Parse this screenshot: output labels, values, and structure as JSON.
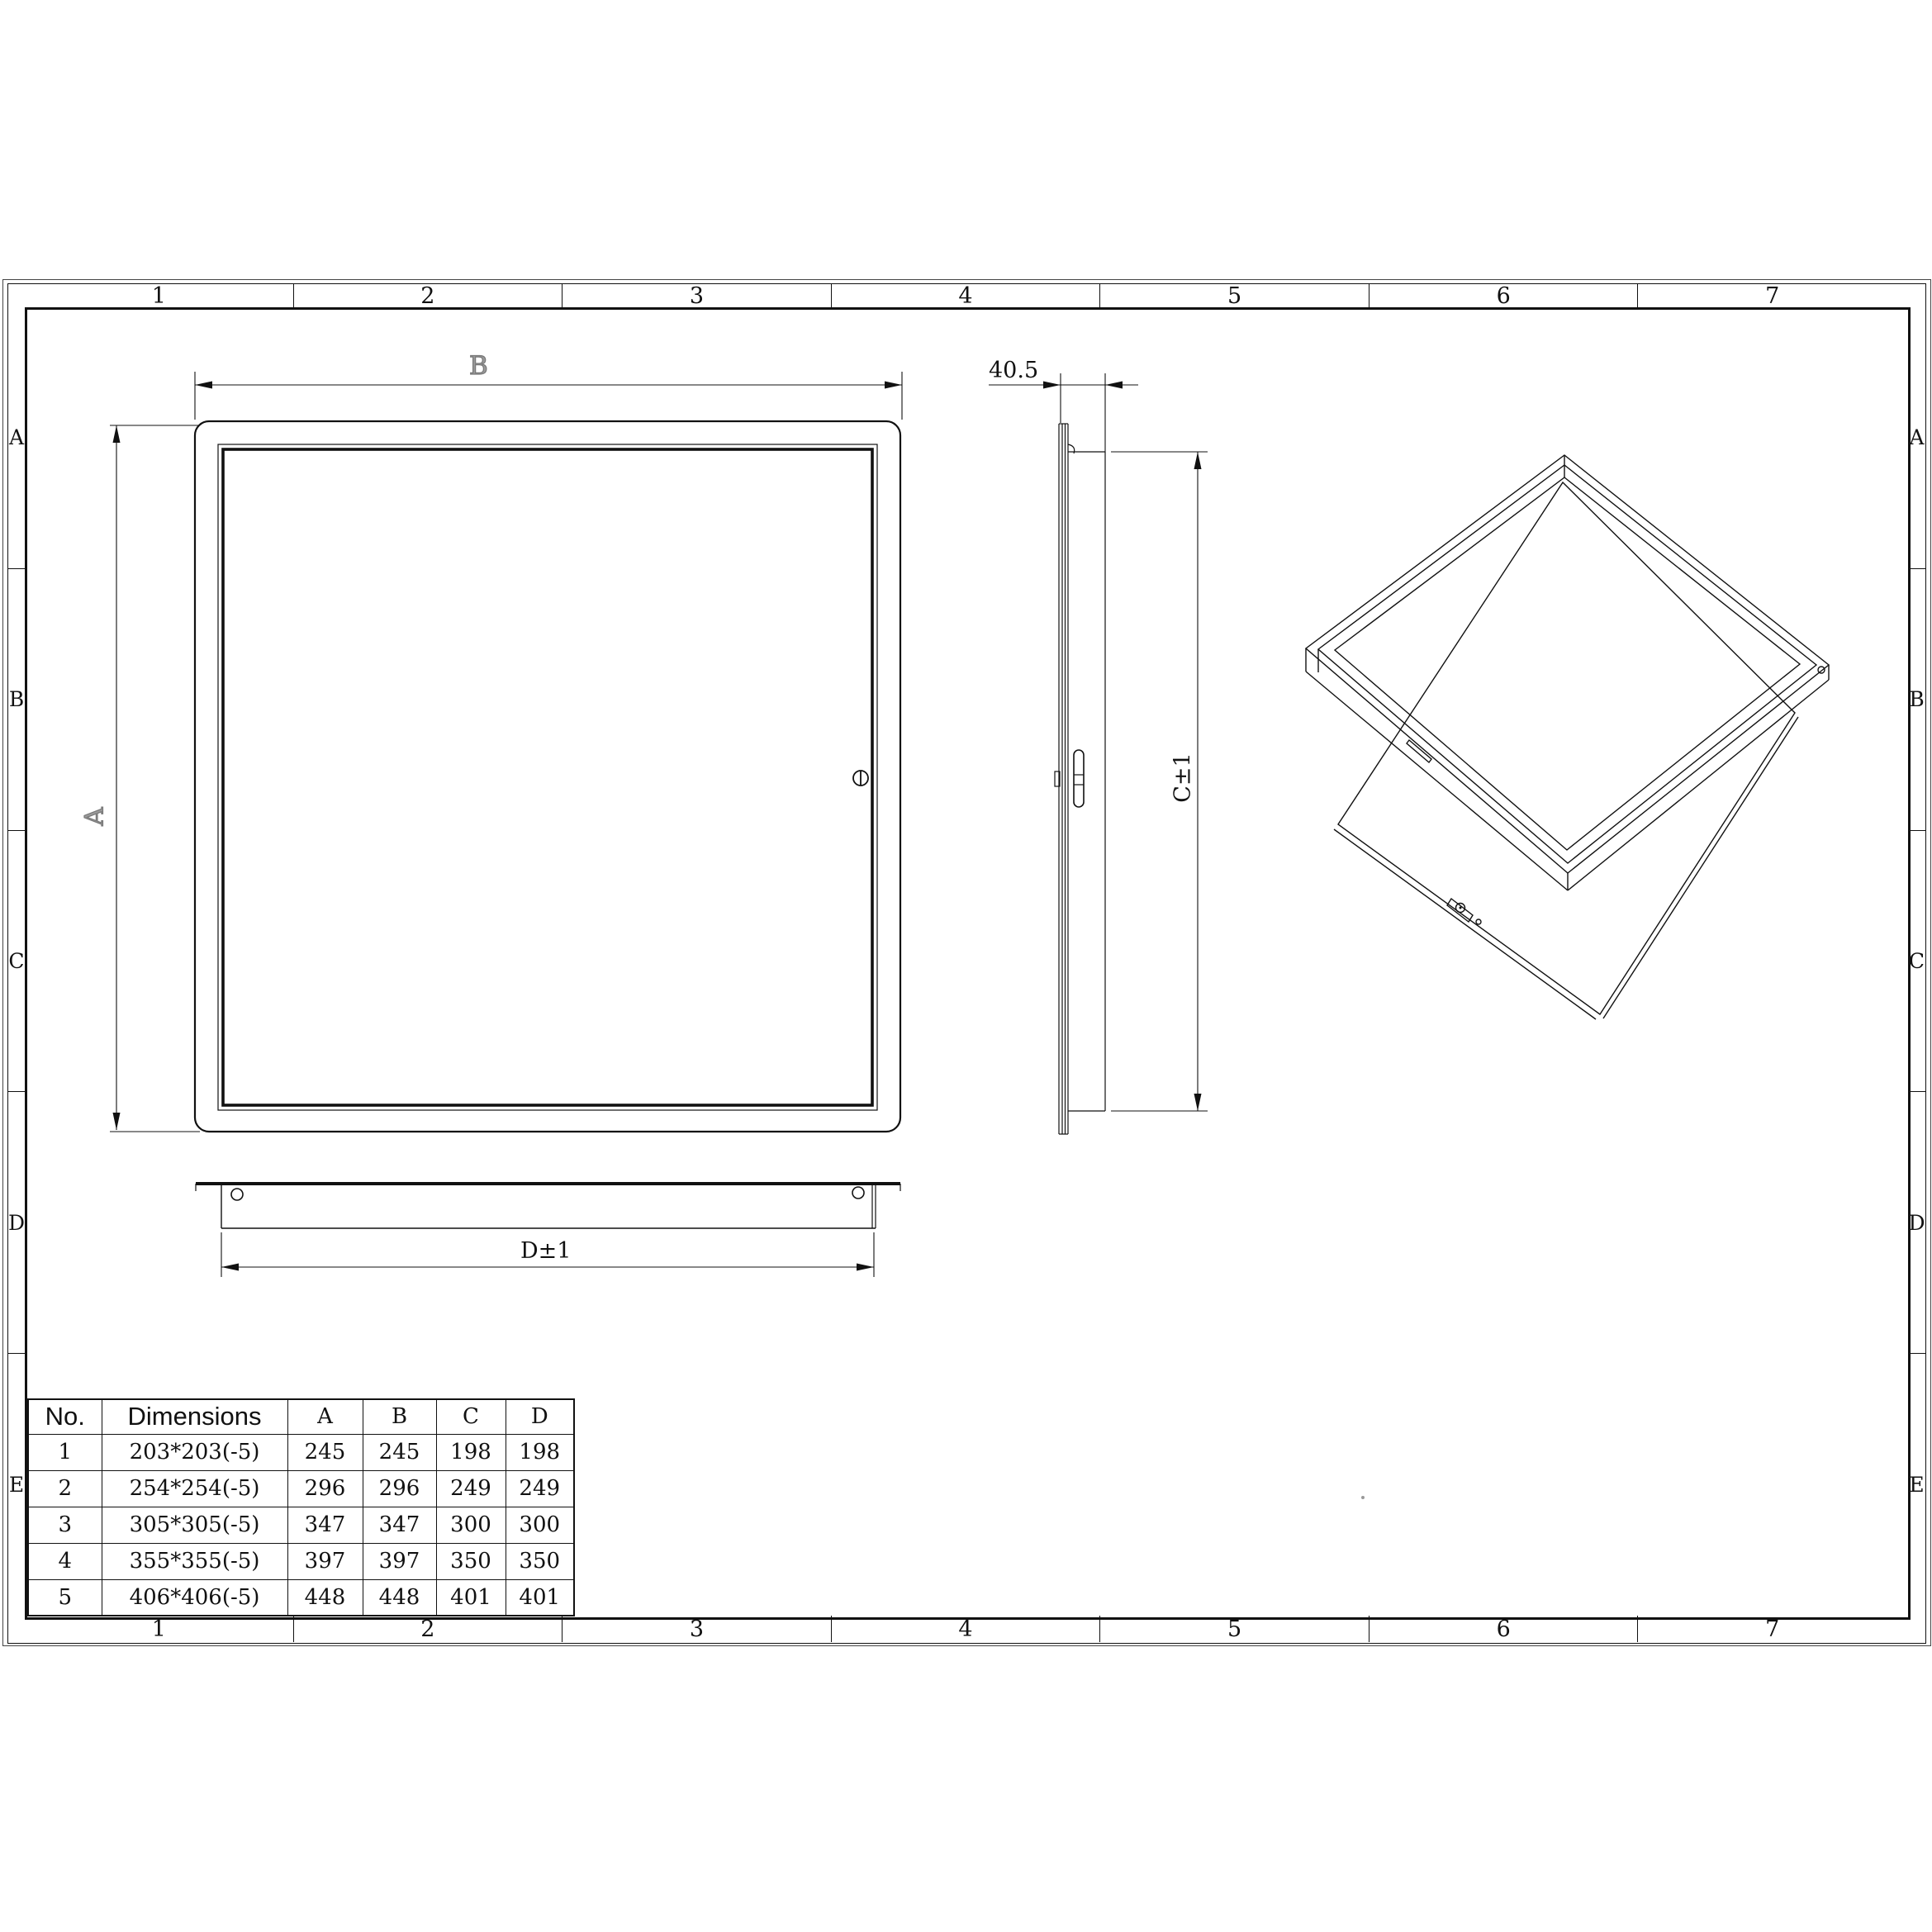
{
  "sheet": {
    "zone_columns": [
      "1",
      "2",
      "3",
      "4",
      "5",
      "6",
      "7"
    ],
    "zone_rows": [
      "A",
      "B",
      "C",
      "D",
      "E"
    ]
  },
  "labels": {
    "front_width": "B",
    "front_height": "A",
    "side_depth": "40.5",
    "side_height": "C±1",
    "bottom_width": "D±1"
  },
  "table": {
    "headers": [
      "No.",
      "Dimensions",
      "A",
      "B",
      "C",
      "D"
    ],
    "rows": [
      [
        "1",
        "203*203(-5)",
        "245",
        "245",
        "198",
        "198"
      ],
      [
        "2",
        "254*254(-5)",
        "296",
        "296",
        "249",
        "249"
      ],
      [
        "3",
        "305*305(-5)",
        "347",
        "347",
        "300",
        "300"
      ],
      [
        "4",
        "355*355(-5)",
        "397",
        "397",
        "350",
        "350"
      ],
      [
        "5",
        "406*406(-5)",
        "448",
        "448",
        "401",
        "401"
      ]
    ]
  }
}
